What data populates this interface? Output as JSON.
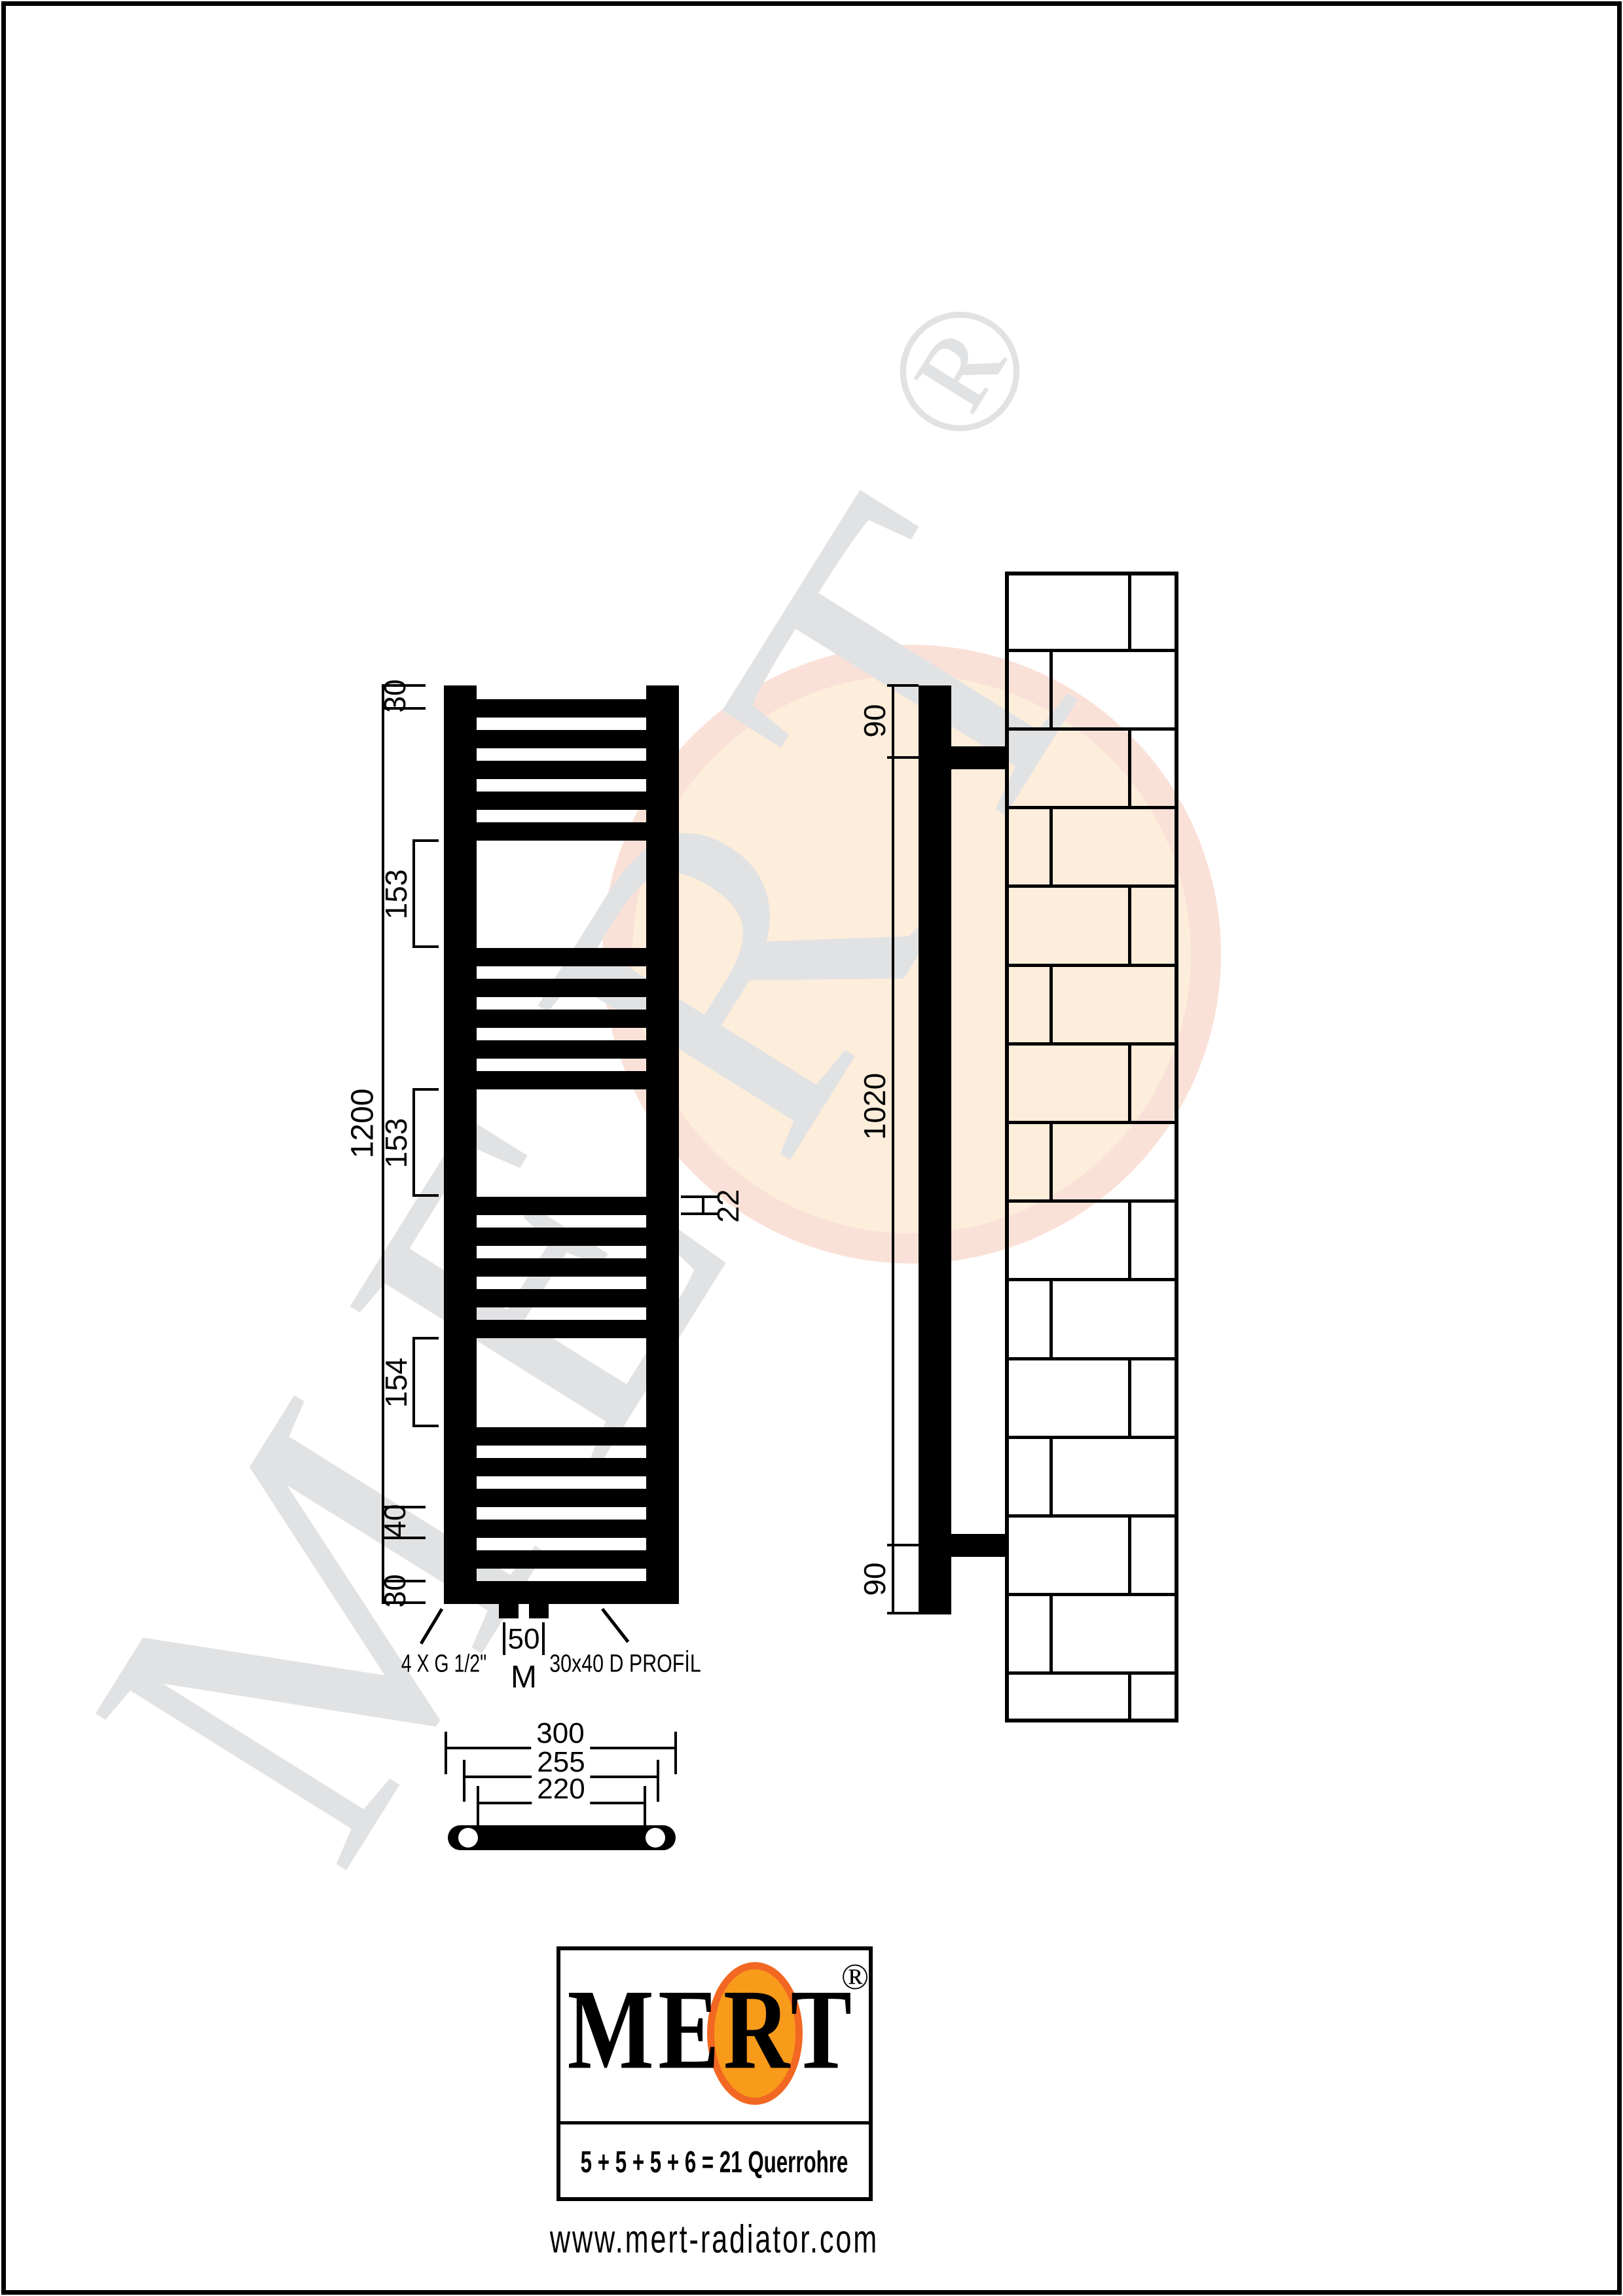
{
  "watermark": {
    "text": "MERT",
    "reg": "®",
    "color": "#E1E2E4",
    "circle_fill": "#FDEDDB",
    "circle_ring": "#FAE1D8"
  },
  "front_view": {
    "querrohre_groups": [
      5,
      5,
      5,
      6
    ],
    "dims": {
      "overall_height": "1200",
      "top_offset": "30",
      "gap1": "153",
      "gap2": "153",
      "gap3": "154",
      "pitch": "40",
      "bottom_profile": "30",
      "rung_size": "22",
      "center_distance": "50"
    },
    "labels": {
      "connections": "4 X G 1/2\"",
      "middle_connection": "M",
      "profile": "30x40 D PROFİL"
    }
  },
  "side_view": {
    "dims": {
      "top_bracket": "90",
      "bracket_span": "1020",
      "bottom_bracket": "90"
    }
  },
  "bottom_view": {
    "dims": {
      "outer_width": "300",
      "mid_width": "255",
      "inner_width": "220"
    }
  },
  "logo": {
    "name": "MERT",
    "reg": "®",
    "formula": "5 + 5 + 5 + 6 = 21 Querrohre",
    "website": "www.mert-radiator.com",
    "orange": "#F89B1B",
    "orange_border": "#F26822"
  }
}
